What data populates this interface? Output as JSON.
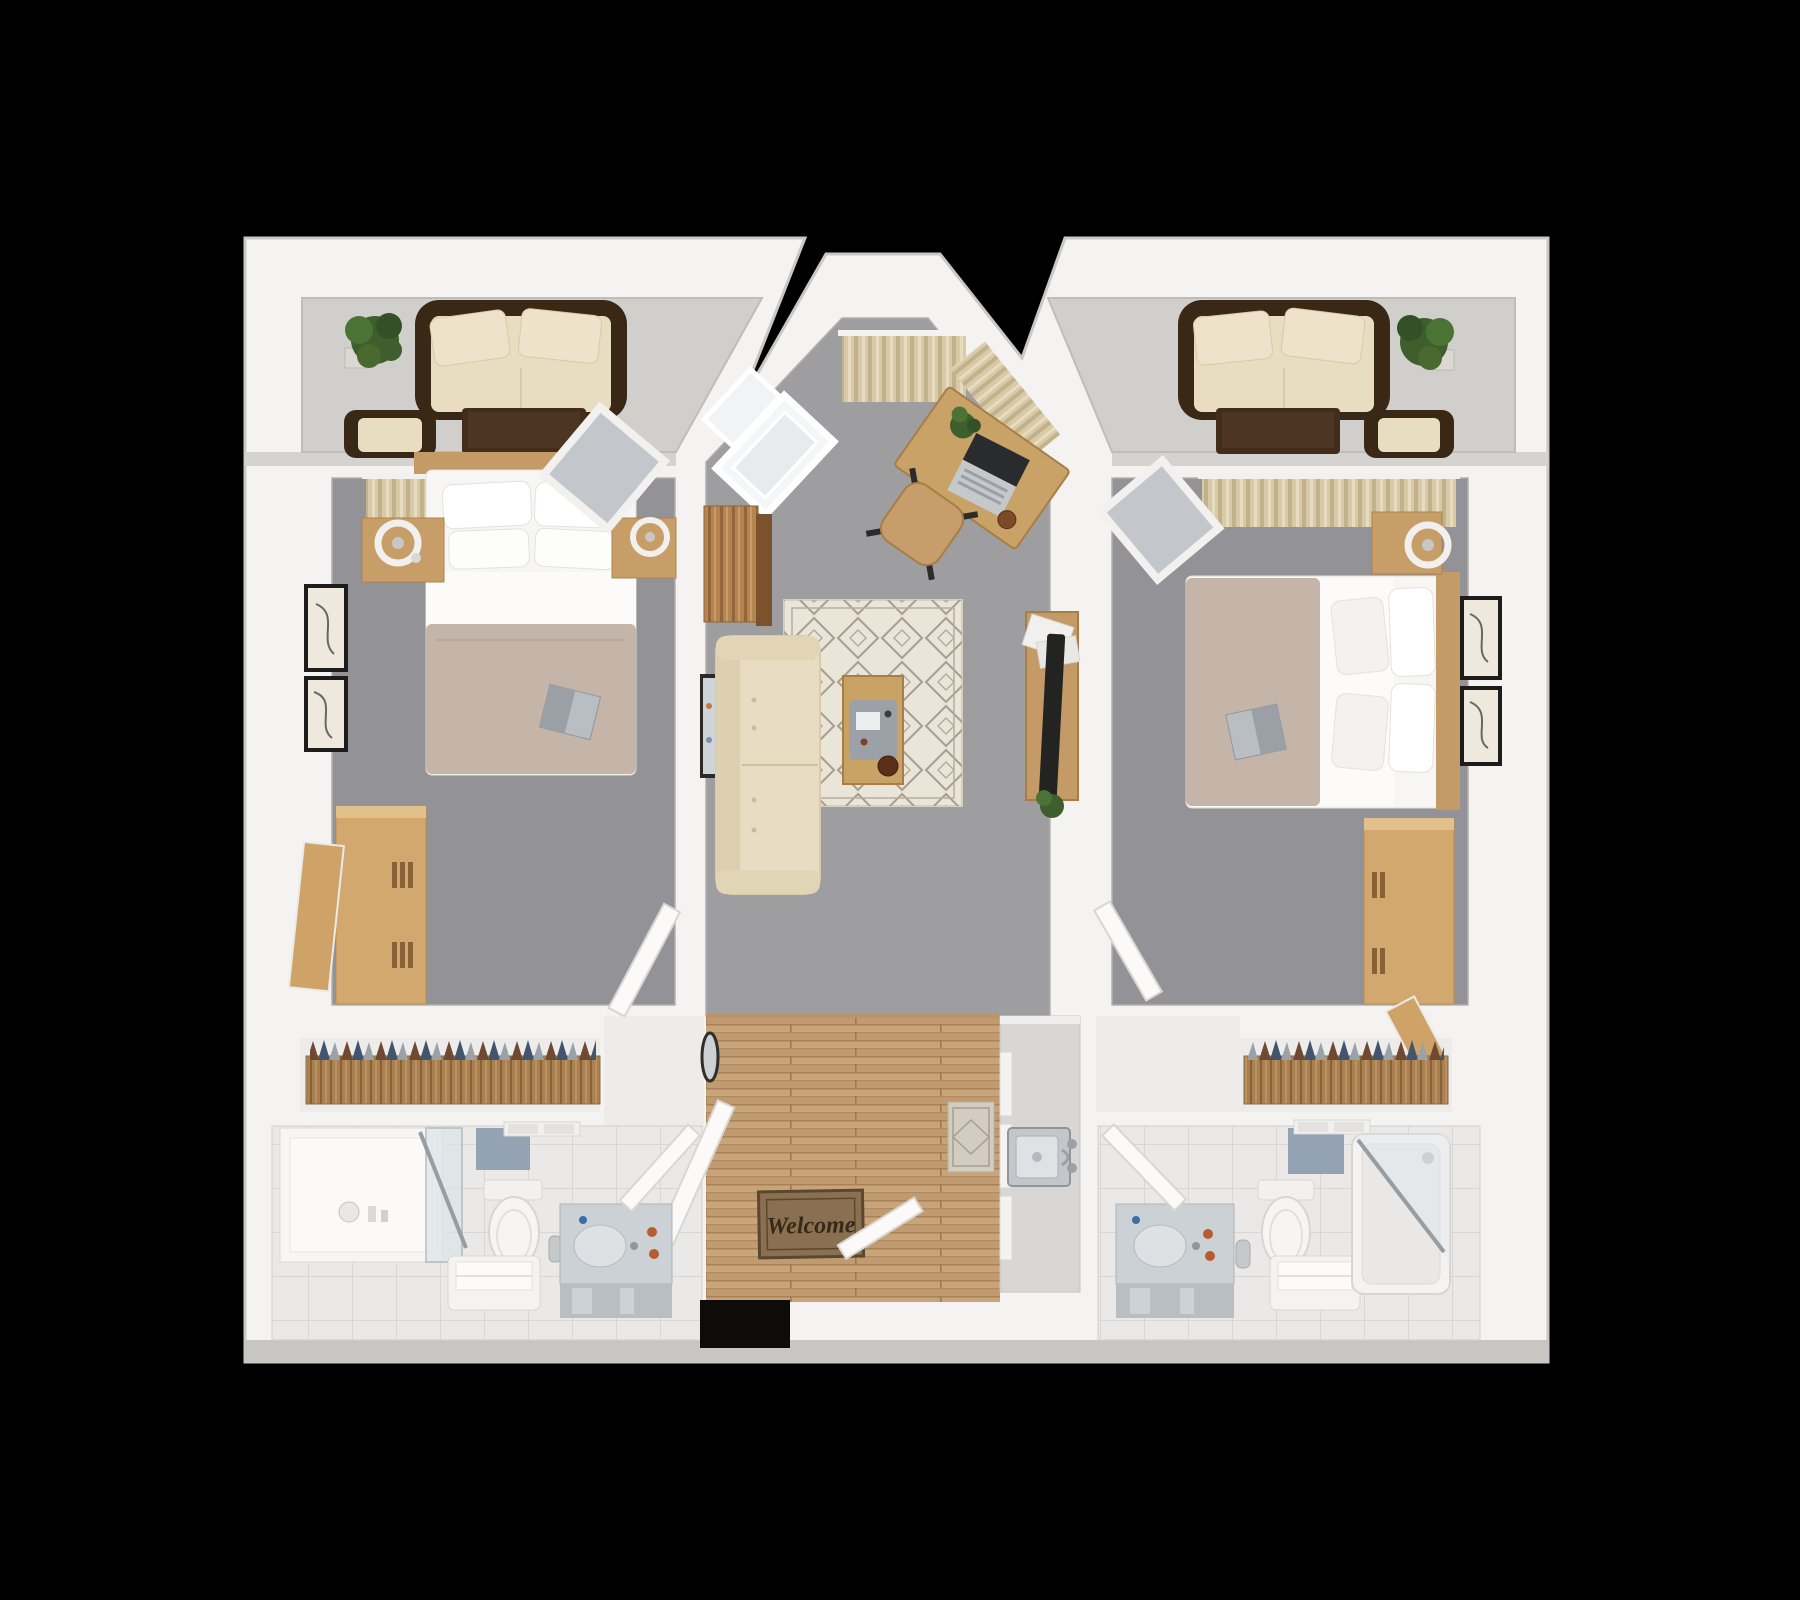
{
  "scene": {
    "kind": "3d-rendered floor plan, top-down view, two-bedroom two-bath apartment",
    "background": "#000000"
  },
  "entry": {
    "mat_text": "Welcome"
  },
  "palette": {
    "wall_white": "#f4f3f1",
    "wall_edge": "#c8c6c3",
    "carpet_bedroom": "#939296",
    "carpet_living": "#9e9da0",
    "balcony_floor": "#d1cfcc",
    "tile_bath": "#eae9e7",
    "closet_floor": "#edecea",
    "wood_floor": "#c8a47a",
    "oak_furniture": "#c9a268",
    "dark_wicker": "#3a2817",
    "cushion_beige": "#e8ddc2",
    "blanket_taupe": "#c5b4a8",
    "rug_cream": "#eae5d9",
    "plant_green": "#3e5f2d",
    "glass_blue": "#dce4e8",
    "accent_tile_blue": "#93a3b4",
    "mat_brown": "#8a7050",
    "tv_black": "#232322"
  },
  "rooms": {
    "balcony_left": {
      "furniture": [
        "wicker-loveseat",
        "back-pillows",
        "coffee-table",
        "wicker-chair",
        "potted-plant"
      ]
    },
    "balcony_right": {
      "furniture": [
        "wicker-loveseat",
        "back-pillows",
        "coffee-table",
        "wicker-chair",
        "potted-plant"
      ]
    },
    "living_room": {
      "furniture": [
        "bay-window-curtains",
        "open-window-sash",
        "desk",
        "laptop",
        "desk-plant",
        "desk-chair",
        "storage-cabinet",
        "sofa",
        "leaning-art",
        "area-rug",
        "coffee-table-tray",
        "tv-console",
        "tv",
        "magazines",
        "floor-plant"
      ]
    },
    "bedroom_left": {
      "furniture": [
        "curtains",
        "double-bed",
        "pillows",
        "book",
        "nightstand-lamp-left",
        "nightstand-lamp-right",
        "wall-art",
        "wall-art",
        "wardrobe-open-door",
        "leaning-mirror"
      ]
    },
    "bedroom_right": {
      "furniture": [
        "curtains",
        "double-bed",
        "pillows",
        "book",
        "nightstand-lamp",
        "wall-art",
        "wall-art",
        "wardrobe-open-door",
        "leaning-mirror"
      ]
    },
    "closet_left": {
      "furniture": [
        "hanging-clothes",
        "wood-shelf"
      ]
    },
    "closet_right": {
      "furniture": [
        "hanging-clothes",
        "wood-shelf"
      ]
    },
    "bathroom_left": {
      "fixtures": [
        "shower-glass",
        "towel-bar",
        "accent-tile",
        "toilet",
        "paper-bin",
        "bench-towel",
        "vanity-sink",
        "door"
      ]
    },
    "bathroom_right": {
      "fixtures": [
        "vanity-sink",
        "toilet",
        "paper-bin",
        "bench-towel",
        "accent-tile",
        "towel-bar",
        "bathtub-glass",
        "door"
      ]
    },
    "entry_hall": {
      "items": [
        "wood-plank-floor",
        "welcome-mat",
        "entry-doors",
        "small-rug",
        "oval-wall-mirror",
        "kitchen-counter",
        "kitchen-sink",
        "door-opening"
      ]
    }
  }
}
